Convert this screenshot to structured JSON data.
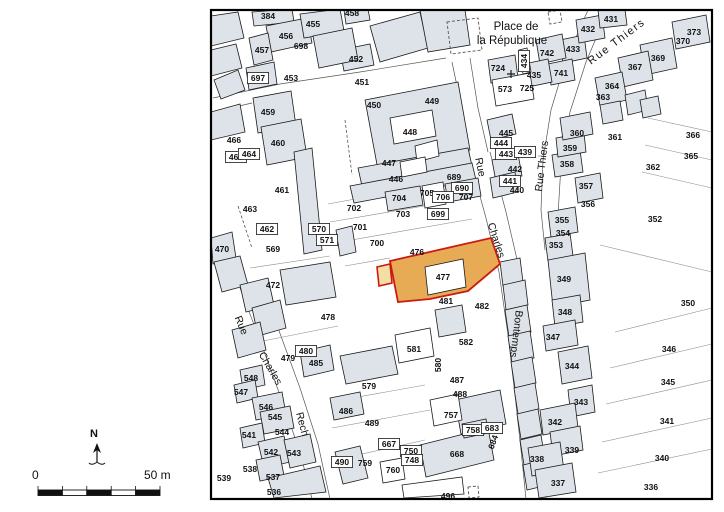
{
  "title": "Cadastral parcel map with highlighted parcel 477",
  "colors": {
    "building": "#dde3e9",
    "outline": "#1a1a1a",
    "parcel_line": "#8a8a8a",
    "street_line": "#555555",
    "highlight_fill": "#e8ab55",
    "highlight_notch": "#f3dfa4",
    "highlight_stroke": "#cc1a10",
    "frame": "#000000",
    "label": "#111111"
  },
  "map": {
    "frame": {
      "x": 211,
      "y": 10,
      "w": 501,
      "h": 489
    },
    "church_cross": {
      "x": 511,
      "y": 74
    },
    "streets_edges": [
      "240,288 258,335 280,395 300,452 312,499",
      "260,280 278,328 300,388 318,444 330,499",
      "470,160 486,218 499,272 508,335 515,395 521,450 526,499",
      "490,152 506,212 519,268 528,335 535,395 541,450 546,499",
      "588,10 566,60 551,110 543,160 541,210 545,250",
      "608,10 586,62 570,112 561,165 558,215",
      "213,98 280,84 360,72 446,58",
      "213,112 252,103",
      "452,62 462,110 470,158",
      "470,58 478,108 488,152"
    ],
    "parcel_lines": [
      "328,204 388,193",
      "330,222 430,205",
      "334,243 472,219",
      "345,266 390,258",
      "615,332 712,308",
      "610,368 712,344",
      "606,404 712,380",
      "602,442 712,418",
      "598,473 712,449",
      "600,245 712,272",
      "648,118 712,132",
      "645,145 712,160",
      "642,172 712,188",
      "330,402 425,385",
      "332,428 430,410",
      "344,458 425,440",
      "250,268 330,256",
      "258,342 338,326"
    ],
    "buildings": [
      "211,16 238,12 244,38 211,46",
      "211,50 236,44 242,68 211,76",
      "214,80 238,70 245,90 221,99",
      "252,12 292,9 294,22 254,26",
      "266,26 307,18 312,43 271,52",
      "300,14 340,9 344,31 304,38",
      "344,10 368,9 370,20 346,24",
      "249,38 268,33 273,60 254,65",
      "246,68 274,62 277,84 249,90",
      "340,50 370,44 374,65 344,71",
      "313,36 352,28 358,60 319,68",
      "370,26 420,12 428,48 380,62",
      "420,10 465,10 470,45 428,52",
      "400,95 450,84 454,104 404,115",
      "365,100 458,82 470,150 378,170",
      "358,168 468,148 472,166 362,186",
      "350,186 472,163 476,180 354,203",
      "385,192 420,186 423,205 388,211",
      "445,184 478,178 481,196 448,202",
      "253,98 291,91 296,126 258,133",
      "261,127 301,119 307,157 267,165",
      "211,112 240,104 245,132 211,140",
      "294,152 312,148 322,250 304,254",
      "336,230 352,226 356,252 340,256",
      "211,238 232,232 236,258 213,264",
      "214,262 240,256 248,285 222,292",
      "240,285 268,278 274,305 246,312",
      "252,308 280,300 286,328 258,336",
      "232,330 260,322 266,350 238,358",
      "280,270 330,262 336,297 286,305",
      "300,352 330,345 334,370 304,377",
      "240,370 262,365 265,385 243,390",
      "234,385 255,380 258,398 237,403",
      "252,398 282,392 286,414 256,420",
      "260,412 290,406 294,428 264,434",
      "240,428 262,423 265,443 243,448",
      "258,442 284,436 290,462 264,468",
      "284,440 310,434 316,462 290,468",
      "256,460 280,455 284,476 260,481",
      "268,478 320,466 326,492 274,498",
      "340,356 392,346 398,374 346,384",
      "435,310 462,305 466,332 439,337",
      "330,398 360,392 364,414 334,420",
      "455,400 500,390 506,424 461,434",
      "420,445 488,428 494,460 426,477",
      "462,424 486,419 488,433 464,438",
      "335,452 360,446 368,478 343,484",
      "487,120 512,114 516,134 491,140",
      "492,160 518,154 522,176 496,182",
      "490,178 515,172 518,192 493,198",
      "500,262 520,258 523,282 503,286",
      "503,285 525,280 528,305 506,310",
      "505,310 527,305 531,332 509,337",
      "508,336 530,331 534,358 512,363",
      "511,362 532,357 536,383 515,388",
      "514,388 535,383 539,409 518,414",
      "517,414 538,409 542,434 521,439",
      "520,440 541,435 545,460 524,465",
      "523,465 544,460 548,485 527,490",
      "545,238 570,233 573,256 548,261",
      "548,260 585,253 590,300 553,307",
      "552,300 580,295 583,322 555,327",
      "543,326 575,320 578,345 546,351",
      "558,352 588,346 592,378 562,384",
      "568,390 592,385 595,412 571,417",
      "540,410 575,403 578,428 543,435",
      "550,432 580,426 583,450 553,456",
      "528,448 560,442 564,470 532,476",
      "535,470 572,463 576,492 539,498",
      "548,212 575,207 578,232 551,237",
      "575,178 600,173 603,198 578,203",
      "552,155 580,150 583,172 555,177",
      "556,138 584,133 586,152 558,157",
      "560,118 590,112 593,134 563,140",
      "560,40 584,35 587,58 563,63",
      "576,20 602,15 605,38 579,43",
      "598,10 625,10 627,25 600,28",
      "672,22 706,15 710,42 676,49",
      "640,45 672,38 677,68 645,75",
      "618,58 648,51 653,80 623,87",
      "595,78 622,72 627,100 600,106",
      "600,105 620,101 623,120 603,124",
      "625,95 645,90 648,110 628,115",
      "640,100 658,96 661,114 643,118",
      "488,60 515,55 518,78 491,83",
      "536,40 562,34 566,58 540,64",
      "548,64 572,59 575,80 551,85",
      "524,64 548,59 552,82 528,87"
    ],
    "white_shapes": [
      "390,118 432,110 436,136 394,144",
      "415,146 437,140 439,156 417,162",
      "400,162 425,157 427,172 402,177",
      "422,186 443,182 446,204 425,208",
      "492,80 530,73 534,99 496,106",
      "519,50 527,48 531,72 523,74",
      "395,335 430,328 434,356 399,363",
      "430,400 458,394 462,420 434,426",
      "402,485 462,477 464,494 404,498",
      "380,462 402,458 405,479 383,483"
    ],
    "dashed_shapes": [
      "447,22 478,18 482,50 451,54",
      "548,12 560,10 562,22 550,24",
      "468,487 478,486 479,497 469,498"
    ],
    "dashed_lines": [
      "238,206 252,248",
      "345,120 352,175"
    ],
    "highlight": {
      "parcel_number": "477",
      "notch": "377,267 390,264 392,283 379,286",
      "main": "390,261 491,238 500,264 468,291 430,299 398,302",
      "inner_building": "425,267 463,259 466,287 428,295"
    },
    "parcel_labels": [
      {
        "t": "384",
        "x": 268,
        "y": 16
      },
      {
        "t": "456",
        "x": 286,
        "y": 36
      },
      {
        "t": "455",
        "x": 313,
        "y": 24
      },
      {
        "t": "458",
        "x": 352,
        "y": 13
      },
      {
        "t": "457",
        "x": 262,
        "y": 50
      },
      {
        "t": "698",
        "x": 301,
        "y": 46
      },
      {
        "t": "452",
        "x": 356,
        "y": 59
      },
      {
        "t": "697",
        "x": 258,
        "y": 78,
        "boxed": true
      },
      {
        "t": "453",
        "x": 291,
        "y": 78
      },
      {
        "t": "451",
        "x": 362,
        "y": 82
      },
      {
        "t": "459",
        "x": 268,
        "y": 112
      },
      {
        "t": "450",
        "x": 374,
        "y": 105
      },
      {
        "t": "449",
        "x": 432,
        "y": 101
      },
      {
        "t": "448",
        "x": 410,
        "y": 132
      },
      {
        "t": "447",
        "x": 389,
        "y": 163
      },
      {
        "t": "446",
        "x": 396,
        "y": 179
      },
      {
        "t": "689",
        "x": 454,
        "y": 177
      },
      {
        "t": "690",
        "x": 462,
        "y": 188,
        "boxed": true
      },
      {
        "t": "705",
        "x": 427,
        "y": 193
      },
      {
        "t": "704",
        "x": 399,
        "y": 198
      },
      {
        "t": "706",
        "x": 443,
        "y": 197,
        "boxed": true
      },
      {
        "t": "707",
        "x": 466,
        "y": 197
      },
      {
        "t": "703",
        "x": 403,
        "y": 214
      },
      {
        "t": "699",
        "x": 438,
        "y": 214,
        "boxed": true
      },
      {
        "t": "702",
        "x": 354,
        "y": 208
      },
      {
        "t": "701",
        "x": 360,
        "y": 227
      },
      {
        "t": "700",
        "x": 377,
        "y": 243
      },
      {
        "t": "570",
        "x": 319,
        "y": 229,
        "boxed": true
      },
      {
        "t": "571",
        "x": 327,
        "y": 240,
        "boxed": true
      },
      {
        "t": "569",
        "x": 273,
        "y": 249
      },
      {
        "t": "462",
        "x": 267,
        "y": 229,
        "boxed": true
      },
      {
        "t": "470",
        "x": 222,
        "y": 249
      },
      {
        "t": "463",
        "x": 250,
        "y": 209
      },
      {
        "t": "461",
        "x": 282,
        "y": 190
      },
      {
        "t": "460",
        "x": 278,
        "y": 143
      },
      {
        "t": "466",
        "x": 234,
        "y": 140
      },
      {
        "t": "465",
        "x": 236,
        "y": 157,
        "boxed": true
      },
      {
        "t": "464",
        "x": 249,
        "y": 154,
        "boxed": true
      },
      {
        "t": "472",
        "x": 273,
        "y": 285
      },
      {
        "t": "478",
        "x": 328,
        "y": 317
      },
      {
        "t": "476",
        "x": 417,
        "y": 252
      },
      {
        "t": "477",
        "x": 443,
        "y": 277
      },
      {
        "t": "481",
        "x": 446,
        "y": 301
      },
      {
        "t": "482",
        "x": 482,
        "y": 306
      },
      {
        "t": "724",
        "x": 498,
        "y": 68
      },
      {
        "t": "434",
        "x": 524,
        "y": 61,
        "r": -90,
        "boxed": true
      },
      {
        "t": "742",
        "x": 547,
        "y": 53
      },
      {
        "t": "435",
        "x": 534,
        "y": 75
      },
      {
        "t": "741",
        "x": 561,
        "y": 73
      },
      {
        "t": "573",
        "x": 505,
        "y": 89
      },
      {
        "t": "725",
        "x": 527,
        "y": 88
      },
      {
        "t": "433",
        "x": 573,
        "y": 49
      },
      {
        "t": "432",
        "x": 588,
        "y": 29
      },
      {
        "t": "431",
        "x": 611,
        "y": 19
      },
      {
        "t": "373",
        "x": 694,
        "y": 32
      },
      {
        "t": "370",
        "x": 683,
        "y": 41
      },
      {
        "t": "369",
        "x": 658,
        "y": 58
      },
      {
        "t": "367",
        "x": 635,
        "y": 67
      },
      {
        "t": "364",
        "x": 612,
        "y": 86
      },
      {
        "t": "363",
        "x": 603,
        "y": 97
      },
      {
        "t": "361",
        "x": 615,
        "y": 137
      },
      {
        "t": "366",
        "x": 693,
        "y": 135
      },
      {
        "t": "365",
        "x": 691,
        "y": 156
      },
      {
        "t": "362",
        "x": 653,
        "y": 167
      },
      {
        "t": "352",
        "x": 655,
        "y": 219
      },
      {
        "t": "360",
        "x": 577,
        "y": 133
      },
      {
        "t": "359",
        "x": 570,
        "y": 148
      },
      {
        "t": "358",
        "x": 567,
        "y": 164
      },
      {
        "t": "357",
        "x": 586,
        "y": 186
      },
      {
        "t": "356",
        "x": 588,
        "y": 204
      },
      {
        "t": "355",
        "x": 562,
        "y": 220
      },
      {
        "t": "354",
        "x": 563,
        "y": 233
      },
      {
        "t": "353",
        "x": 556,
        "y": 245
      },
      {
        "t": "445",
        "x": 506,
        "y": 133
      },
      {
        "t": "444",
        "x": 501,
        "y": 143,
        "boxed": true
      },
      {
        "t": "443",
        "x": 506,
        "y": 154,
        "boxed": true
      },
      {
        "t": "439",
        "x": 525,
        "y": 152,
        "boxed": true
      },
      {
        "t": "442",
        "x": 515,
        "y": 169
      },
      {
        "t": "441",
        "x": 510,
        "y": 181,
        "boxed": true
      },
      {
        "t": "440",
        "x": 517,
        "y": 190
      },
      {
        "t": "349",
        "x": 564,
        "y": 279
      },
      {
        "t": "348",
        "x": 565,
        "y": 312
      },
      {
        "t": "347",
        "x": 553,
        "y": 337
      },
      {
        "t": "344",
        "x": 572,
        "y": 366
      },
      {
        "t": "343",
        "x": 581,
        "y": 402
      },
      {
        "t": "342",
        "x": 555,
        "y": 422
      },
      {
        "t": "339",
        "x": 572,
        "y": 450
      },
      {
        "t": "338",
        "x": 537,
        "y": 459
      },
      {
        "t": "337",
        "x": 558,
        "y": 483
      },
      {
        "t": "350",
        "x": 688,
        "y": 303
      },
      {
        "t": "346",
        "x": 669,
        "y": 349
      },
      {
        "t": "345",
        "x": 668,
        "y": 382
      },
      {
        "t": "341",
        "x": 667,
        "y": 421
      },
      {
        "t": "340",
        "x": 662,
        "y": 458
      },
      {
        "t": "336",
        "x": 651,
        "y": 487
      },
      {
        "t": "479",
        "x": 288,
        "y": 358
      },
      {
        "t": "480",
        "x": 306,
        "y": 351,
        "boxed": true
      },
      {
        "t": "485",
        "x": 316,
        "y": 363
      },
      {
        "t": "548",
        "x": 251,
        "y": 378
      },
      {
        "t": "547",
        "x": 241,
        "y": 392
      },
      {
        "t": "546",
        "x": 266,
        "y": 407
      },
      {
        "t": "545",
        "x": 275,
        "y": 417
      },
      {
        "t": "544",
        "x": 282,
        "y": 432
      },
      {
        "t": "541",
        "x": 249,
        "y": 435
      },
      {
        "t": "542",
        "x": 271,
        "y": 452
      },
      {
        "t": "543",
        "x": 294,
        "y": 453
      },
      {
        "t": "538",
        "x": 250,
        "y": 469
      },
      {
        "t": "539",
        "x": 224,
        "y": 478
      },
      {
        "t": "537",
        "x": 273,
        "y": 477
      },
      {
        "t": "536",
        "x": 274,
        "y": 492
      },
      {
        "t": "490",
        "x": 342,
        "y": 462,
        "boxed": true
      },
      {
        "t": "759",
        "x": 365,
        "y": 463
      },
      {
        "t": "760",
        "x": 393,
        "y": 470
      },
      {
        "t": "496",
        "x": 448,
        "y": 496
      },
      {
        "t": "486",
        "x": 346,
        "y": 411
      },
      {
        "t": "489",
        "x": 372,
        "y": 423
      },
      {
        "t": "493",
        "x": 385,
        "y": 442
      },
      {
        "t": "579",
        "x": 369,
        "y": 386
      },
      {
        "t": "581",
        "x": 414,
        "y": 349
      },
      {
        "t": "582",
        "x": 466,
        "y": 342
      },
      {
        "t": "580",
        "x": 438,
        "y": 365,
        "r": -90
      },
      {
        "t": "487",
        "x": 457,
        "y": 380
      },
      {
        "t": "488",
        "x": 460,
        "y": 394
      },
      {
        "t": "757",
        "x": 451,
        "y": 415
      },
      {
        "t": "758",
        "x": 473,
        "y": 430,
        "boxed": true
      },
      {
        "t": "683",
        "x": 492,
        "y": 428,
        "boxed": true
      },
      {
        "t": "684",
        "x": 493,
        "y": 442,
        "r": -70
      },
      {
        "t": "667",
        "x": 389,
        "y": 444,
        "boxed": true
      },
      {
        "t": "668",
        "x": 457,
        "y": 454
      },
      {
        "t": "750",
        "x": 411,
        "y": 451,
        "boxed": true
      },
      {
        "t": "748",
        "x": 412,
        "y": 460,
        "boxed": true
      }
    ],
    "street_labels": [
      {
        "t": "Place de",
        "x": 516,
        "y": 26,
        "r": 0,
        "size": 11.5
      },
      {
        "t": "la République",
        "x": 512,
        "y": 40,
        "r": 0,
        "size": 11.5
      },
      {
        "t": "Rue  Thiers",
        "x": 616,
        "y": 41,
        "r": -37,
        "size": 11,
        "ls": 1.5
      },
      {
        "t": "Rue",
        "x": 481,
        "y": 167,
        "r": 78,
        "size": 10.5
      },
      {
        "t": "Charles",
        "x": 497,
        "y": 240,
        "r": 72,
        "size": 10.5
      },
      {
        "t": "Rue Thiers",
        "x": 541,
        "y": 166,
        "r": -83,
        "size": 10.5
      },
      {
        "t": "Bontemps",
        "x": 517,
        "y": 334,
        "r": 97,
        "size": 10.5
      },
      {
        "t": "Rue",
        "x": 242,
        "y": 325,
        "r": 68,
        "size": 10.5
      },
      {
        "t": "Charles",
        "x": 271,
        "y": 368,
        "r": 60,
        "size": 10.5
      },
      {
        "t": "Rech",
        "x": 303,
        "y": 424,
        "r": 75,
        "size": 10.5
      }
    ]
  },
  "legend": {
    "north_label": "N",
    "north_pos": {
      "x": 97,
      "y": 452
    },
    "scale": {
      "start_label": "0",
      "end_label": "50 m",
      "bar_x": 38,
      "bar_y": 490,
      "bar_w": 122,
      "bar_h": 5.5,
      "segment_colors": [
        "#111111",
        "#ffffff",
        "#111111",
        "#ffffff",
        "#111111"
      ]
    }
  }
}
